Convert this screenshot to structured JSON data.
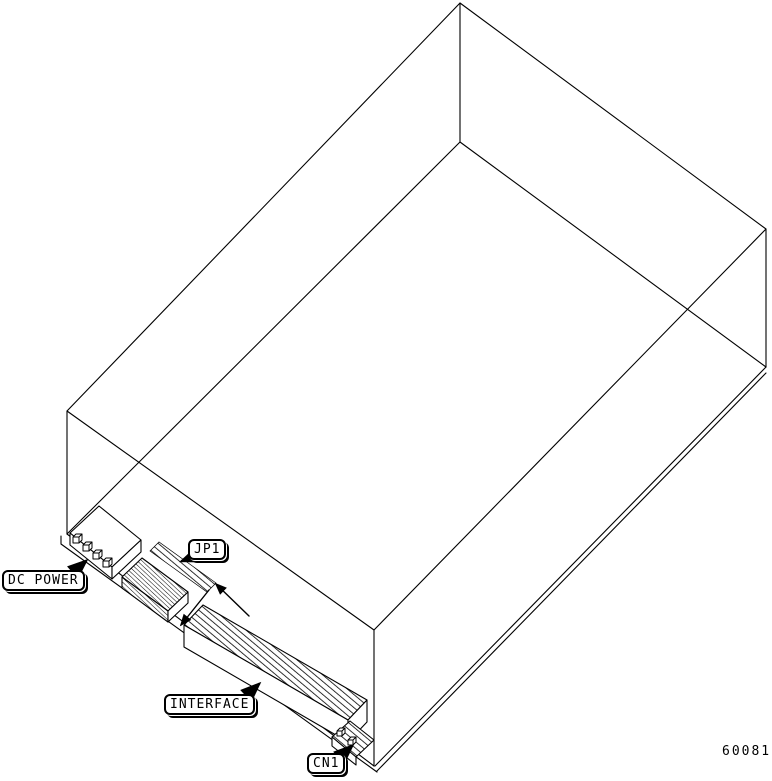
{
  "diagram": {
    "type": "isometric wireframe technical drawing",
    "subject": "disk drive rear connector locations",
    "labels": {
      "dc_power": "DC POWER",
      "jp1": "JP1",
      "interface": "INTERFACE",
      "cn1": "CN1"
    },
    "figure_code": "60081",
    "colors": {
      "background": "#ffffff",
      "line": "#000000"
    }
  }
}
